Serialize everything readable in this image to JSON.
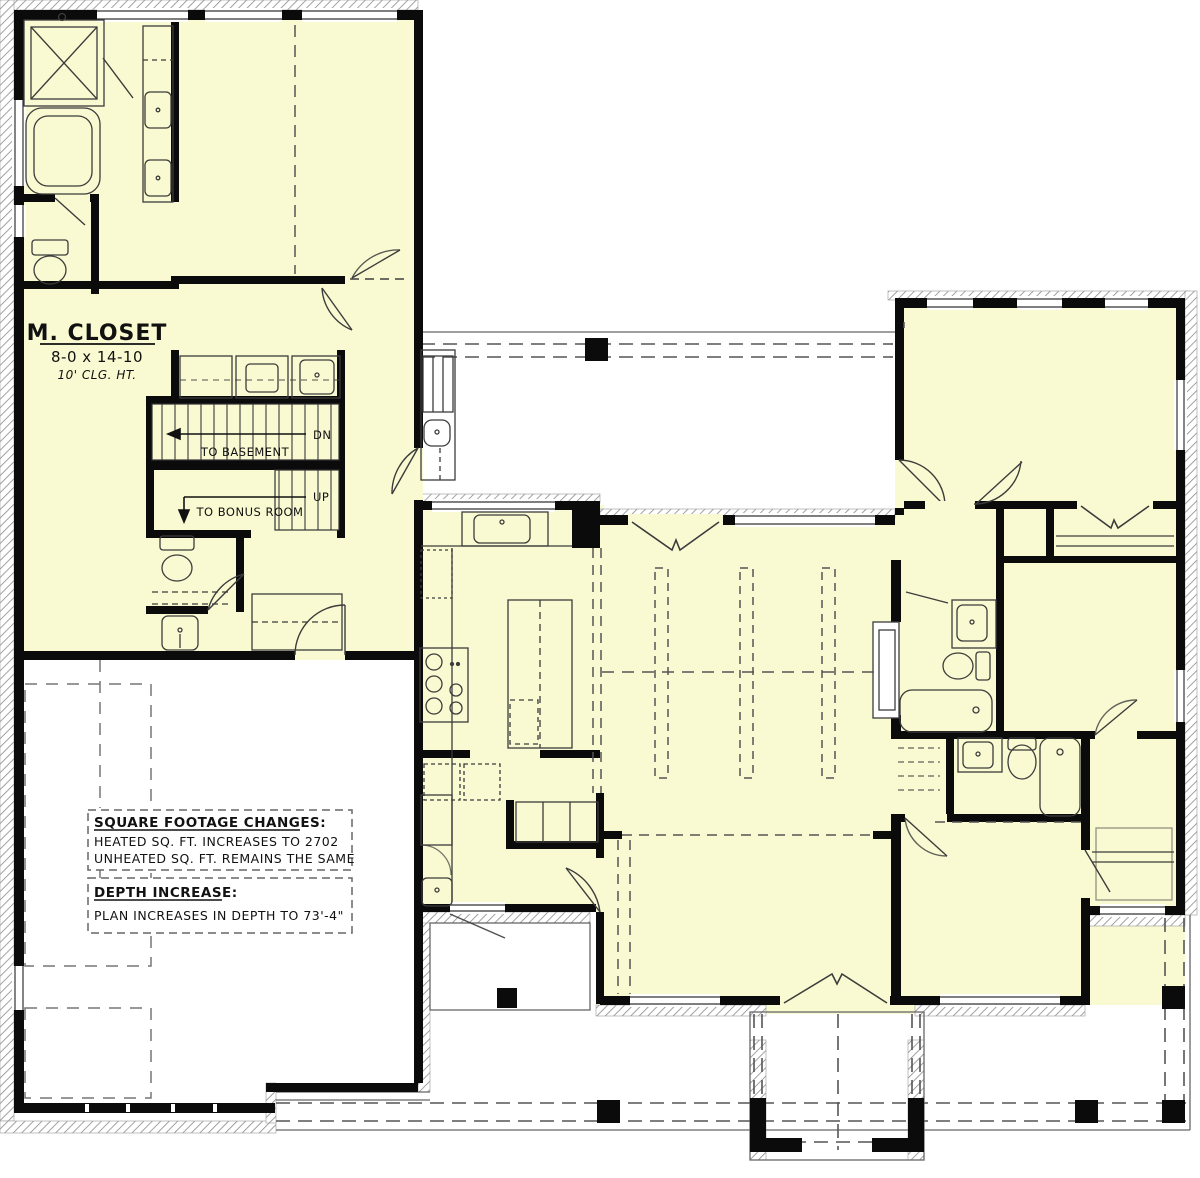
{
  "plan": {
    "type": "architectural-floor-plan",
    "rooms": {
      "m_closet": {
        "name": "M. CLOSET",
        "dims": "8-0 x 14-10",
        "ceiling": "10' CLG. HT."
      }
    },
    "stairs": {
      "basement": {
        "direction": "DN",
        "label": "TO BASEMENT"
      },
      "bonus": {
        "direction": "UP",
        "label": "TO BONUS ROOM"
      }
    },
    "notes": {
      "sqft": {
        "title": "SQUARE FOOTAGE CHANGES:",
        "lines": [
          "HEATED SQ. FT. INCREASES TO 2702",
          "UNHEATED SQ. FT. REMAINS THE SAME"
        ]
      },
      "depth": {
        "title": "DEPTH INCREASE:",
        "lines": [
          "PLAN INCREASES IN DEPTH TO 73'-4\""
        ]
      }
    },
    "colors": {
      "room_fill": "#FAFAD2",
      "wall": "#0b0b0b",
      "line": "#3c3c3c",
      "dash": "#555555",
      "background": "#FFFFFF"
    }
  }
}
